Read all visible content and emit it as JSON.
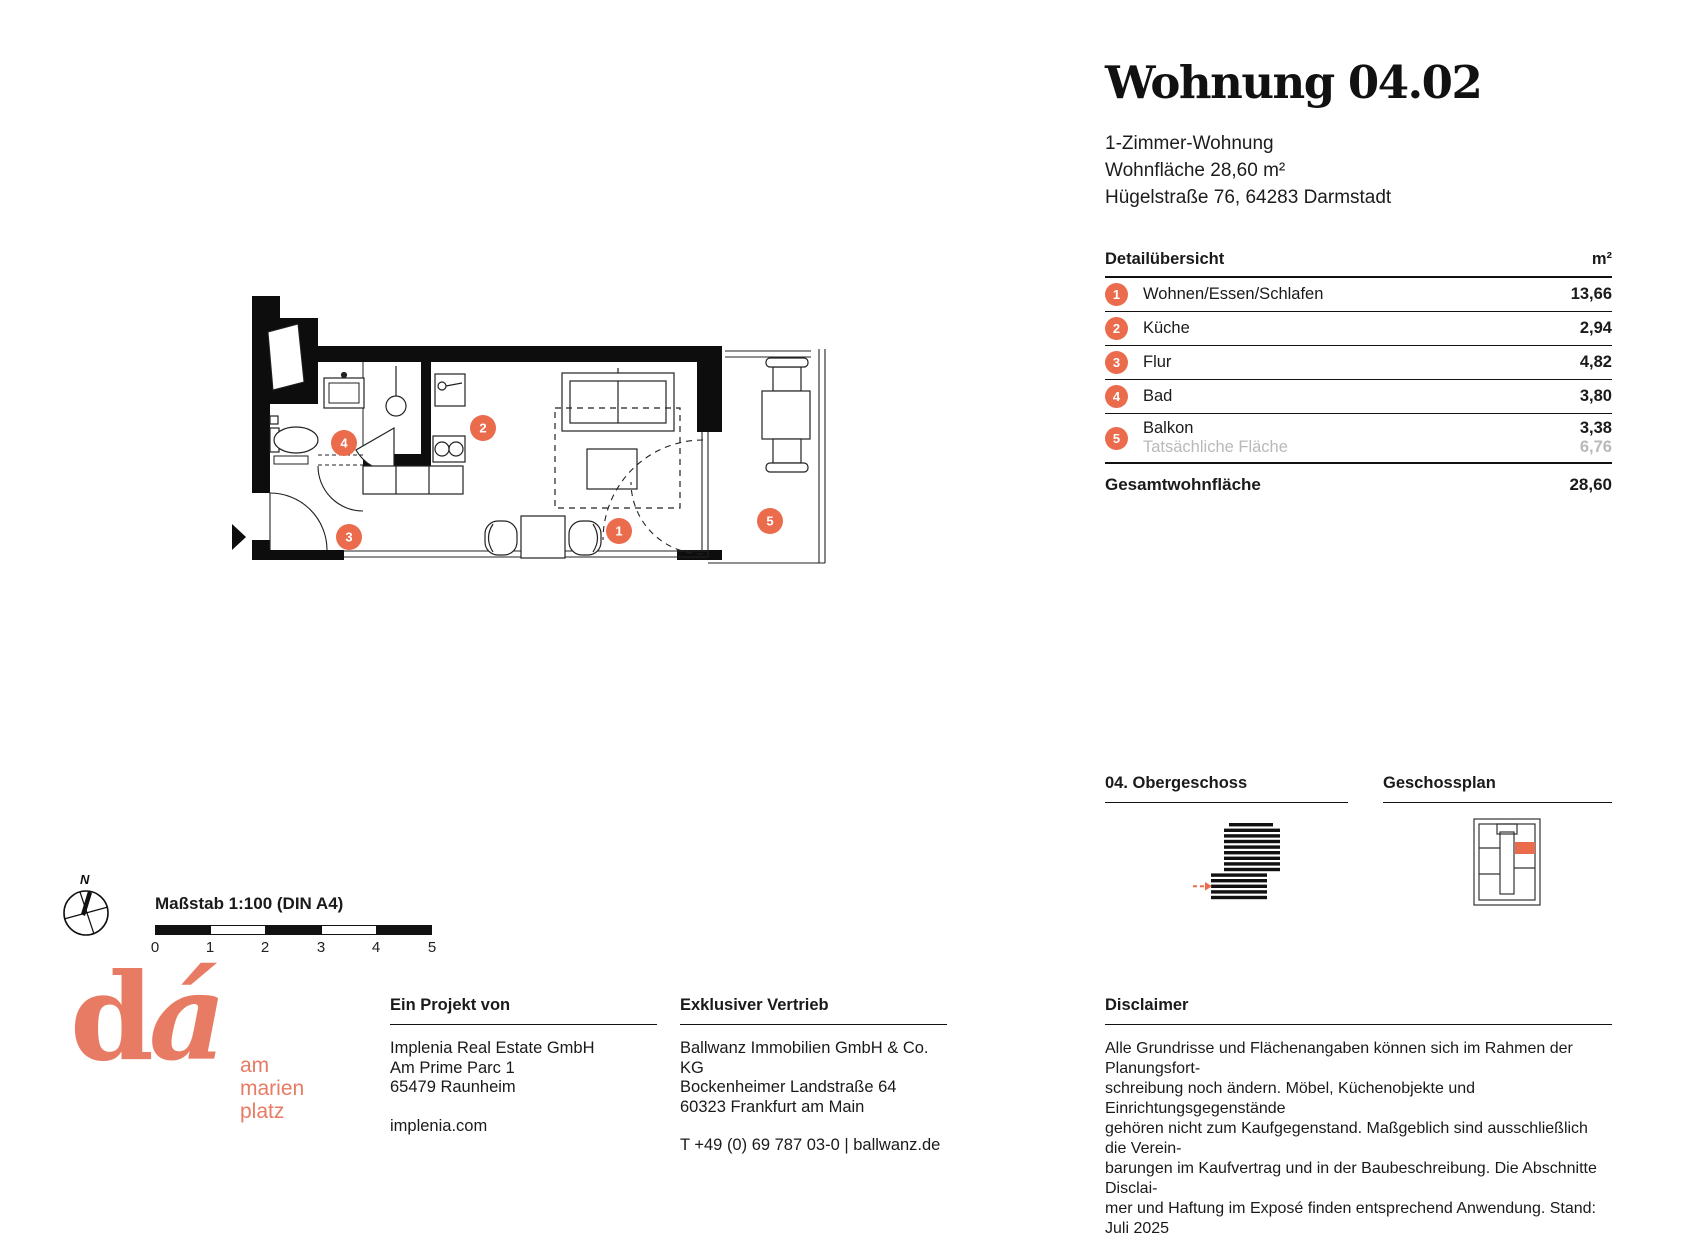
{
  "colors": {
    "accent": "#EB6B4D",
    "logo": "#E87B63",
    "graytext": "#B9B9B9"
  },
  "title": {
    "heading": "Wohnung 04.02",
    "lines": [
      "1-Zimmer-Wohnung",
      "Wohnfläche 28,60 m²",
      "Hügelstraße 76, 64283 Darmstadt"
    ]
  },
  "detail_table": {
    "heading": "Detailübersicht",
    "unit_header": "m²",
    "rows": [
      {
        "num": "1",
        "label": "Wohnen/Essen/Schlafen",
        "value": "13,66"
      },
      {
        "num": "2",
        "label": "Küche",
        "value": "2,94"
      },
      {
        "num": "3",
        "label": "Flur",
        "value": "4,82"
      },
      {
        "num": "4",
        "label": "Bad",
        "value": "3,80"
      },
      {
        "num": "5",
        "label": "Balkon",
        "value": "3,38",
        "sublabel": "Tatsächliche Fläche",
        "subvalue": "6,76"
      }
    ],
    "total_label": "Gesamtwohnfläche",
    "total_value": "28,60"
  },
  "floorplan": {
    "badges": [
      "1",
      "2",
      "3",
      "4",
      "5"
    ]
  },
  "sections": {
    "floor": {
      "heading": "04. Obergeschoss"
    },
    "plan": {
      "heading": "Geschossplan"
    }
  },
  "scale": {
    "north": "N",
    "label": "Maßstab 1:100 (DIN A4)",
    "ticks": [
      "0",
      "1",
      "2",
      "3",
      "4",
      "5"
    ]
  },
  "logo": {
    "d": "d",
    "a": "á",
    "wordmark_lines": [
      "am",
      "marien",
      "platz"
    ]
  },
  "footer": {
    "project": {
      "heading": "Ein Projekt von",
      "lines": [
        "Implenia Real Estate GmbH",
        "Am Prime Parc 1",
        "65479 Raunheim"
      ],
      "link": "implenia.com"
    },
    "sales": {
      "heading": "Exklusiver Vertrieb",
      "lines": [
        "Ballwanz Immobilien GmbH & Co. KG",
        "Bockenheimer Landstraße 64",
        "60323 Frankfurt am Main"
      ],
      "link": "T +49 (0) 69 787 03-0 | ballwanz.de"
    },
    "disclaimer": {
      "heading": "Disclaimer",
      "lines": [
        "Alle Grundrisse und Flächenangaben können sich im Rahmen der Planungsfort-",
        "schreibung noch ändern. Möbel, Küchenobjekte und Einrichtungsgegenstände",
        "gehören nicht zum Kaufgegenstand. Maßgeblich sind ausschließlich die Verein-",
        "barungen im Kaufvertrag und in der Baubeschreibung. Die Abschnitte Disclai-",
        "mer und Haftung im Exposé finden entsprechend Anwendung. Stand: Juli 2025"
      ]
    }
  }
}
